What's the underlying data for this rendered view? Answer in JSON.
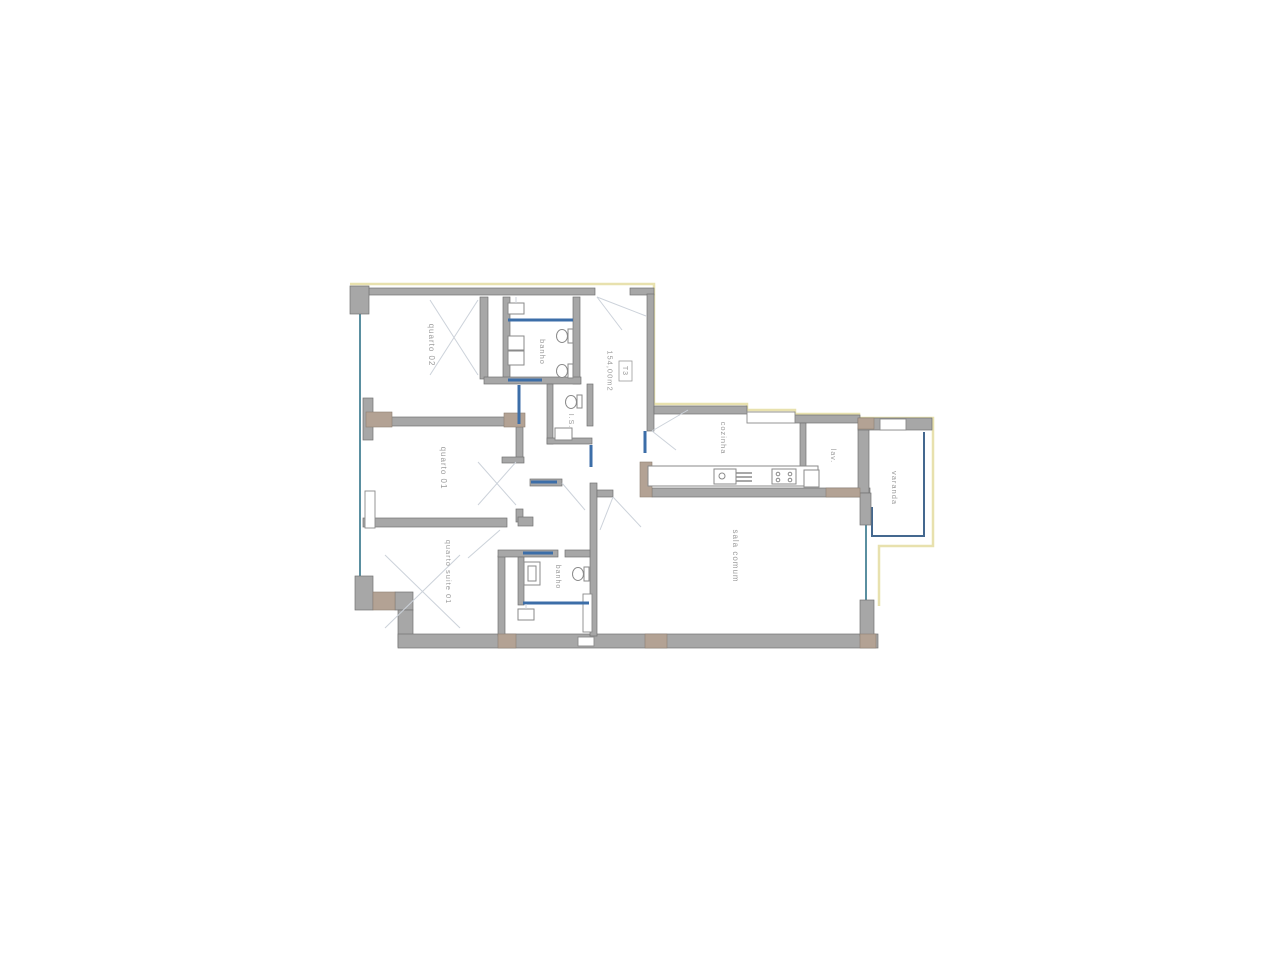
{
  "plan": {
    "unit_label": "T3",
    "area_label": "154,00m2",
    "labels": {
      "quarto_02": "quarto 02",
      "quarto_01": "quarto 01",
      "quarto_suite_01": "quarto suite 01",
      "banho_top": "banho",
      "banho_bottom": "banho",
      "is": "I.S.",
      "cozinha": "cozinha",
      "lav": "lav.",
      "varanda": "varanda",
      "sala_comum": "sala comum"
    },
    "colors": {
      "background": "#ffffff",
      "wall_gray": "#a7a7a7",
      "wall_stroke": "#737373",
      "column_taupe": "#b3a294",
      "door_blue": "#3c6ea8",
      "window_teal": "#5a8fa0",
      "boundary_yellow": "#e8e1ae",
      "label_text": "#9b9b9b",
      "swing_line": "#ccd2da"
    }
  }
}
